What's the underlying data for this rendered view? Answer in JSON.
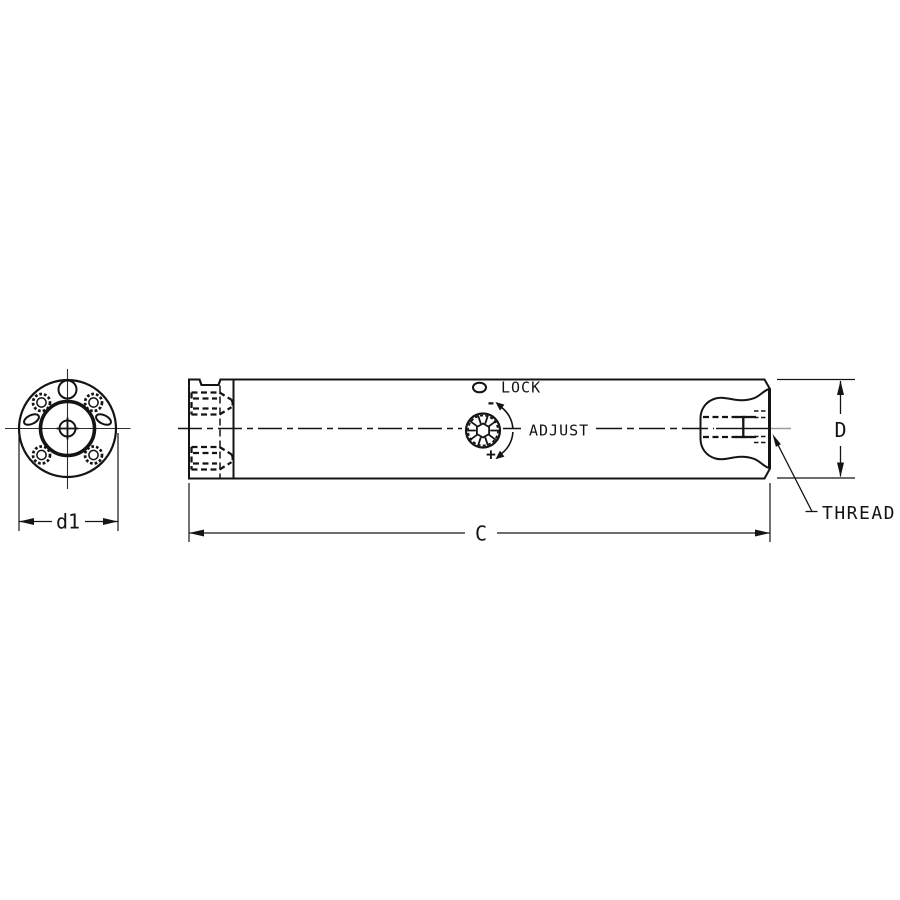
{
  "labels": {
    "lock": "LOCK",
    "adjust": "ADJUST",
    "thread": "THREAD",
    "adjust_minus": "-",
    "adjust_plus": "+"
  },
  "dimensions": {
    "front_diameter": "d1",
    "body_length": "C",
    "body_diameter": "D"
  },
  "colors": {
    "highlight": "#d6dd35",
    "body": "#d2d2d2",
    "pocket": "#ffffff",
    "outline": "#141414",
    "centerline_gray": "#9a9a9a",
    "background": "#ffffff"
  }
}
